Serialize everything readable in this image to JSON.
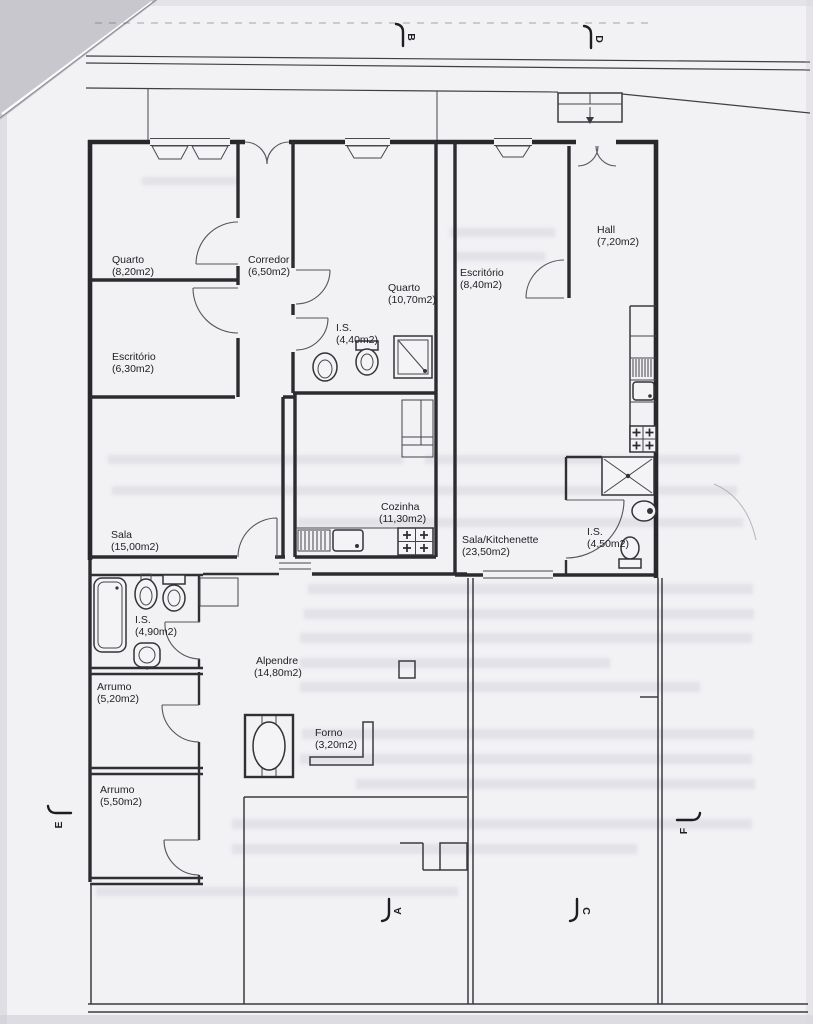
{
  "plan": {
    "sheet": "scanned floor plan",
    "rooms": [
      {
        "name": "Quarto",
        "area": "(8,20m2)"
      },
      {
        "name": "Escritório",
        "area": "(6,30m2)"
      },
      {
        "name": "Corredor",
        "area": "(6,50m2)"
      },
      {
        "name": "Quarto",
        "area": "(10,70m2)"
      },
      {
        "name": "I.S.",
        "area": "(4,40m2)"
      },
      {
        "name": "Escritório",
        "area": "(8,40m2)"
      },
      {
        "name": "Hall",
        "area": "(7,20m2)"
      },
      {
        "name": "Sala",
        "area": "(15,00m2)"
      },
      {
        "name": "Cozinha",
        "area": "(11,30m2)"
      },
      {
        "name": "Sala/Kitchenette",
        "area": "(23,50m2)"
      },
      {
        "name": "I.S.",
        "area": "(4,50m2)"
      },
      {
        "name": "I.S.",
        "area": "(4,90m2)"
      },
      {
        "name": "Arrumo",
        "area": "(5,20m2)"
      },
      {
        "name": "Alpendre",
        "area": "(14,80m2)"
      },
      {
        "name": "Forno",
        "area": "(3,20m2)"
      },
      {
        "name": "Arrumo",
        "area": "(5,50m2)"
      }
    ],
    "section_markers": [
      {
        "label": "B"
      },
      {
        "label": "D"
      },
      {
        "label": "A"
      },
      {
        "label": "C"
      },
      {
        "label": "E"
      },
      {
        "label": "F"
      }
    ],
    "colors": {
      "paper": "#f2f1f4",
      "ink": "#28282c",
      "fold_corner": "#c8c7ce"
    }
  }
}
